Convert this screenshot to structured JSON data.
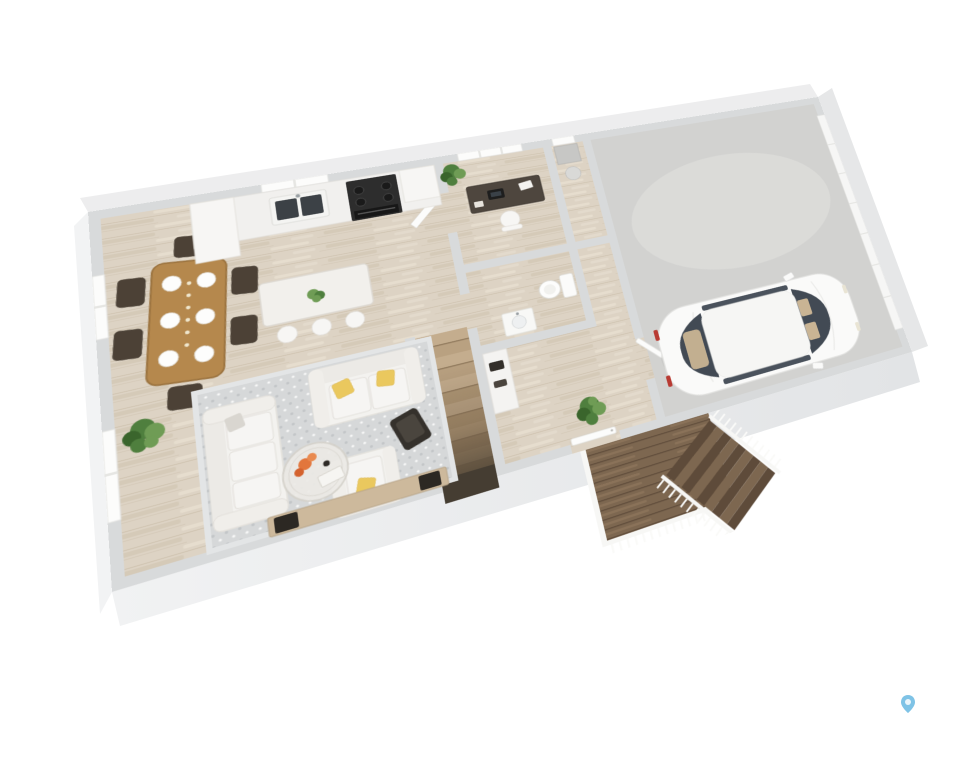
{
  "scene": {
    "type": "3d-floor-plan-render",
    "description": "Isometric 3D rendering of a home's main floor: open-concept dining area, kitchen with island, living room, rear office, powder room, central staircase, entry foyer, attached single-car garage with parked car, and an exterior deck with steps.",
    "background": "#ffffff"
  },
  "rooms": [
    "dining-area",
    "kitchen",
    "living-room",
    "office",
    "powder-room",
    "staircase",
    "entry-foyer",
    "utility-closet",
    "garage",
    "deck"
  ],
  "furniture": [
    "dining-table",
    "dining-chairs",
    "place-settings",
    "kitchen-counter",
    "sink",
    "gas-range",
    "refrigerator-cabinet",
    "kitchen-island",
    "bar-stools",
    "island-plant",
    "sofa",
    "loveseat",
    "armchair",
    "accent-chair",
    "coffee-table",
    "media-console",
    "area-rug",
    "floor-plant",
    "desk",
    "office-chair",
    "office-plant",
    "toilet",
    "vanity-sink",
    "hall-cabinet",
    "foyer-plant",
    "white-car",
    "garage-door",
    "front-door",
    "deck-steps",
    "deck-railing"
  ],
  "watermark": {
    "icon": "map-pin-icon",
    "color": "#7fc3e6",
    "inner": "#eaf5fb"
  },
  "colors": {
    "bg": "#ffffff",
    "wall": "#d8dadb",
    "wallFace": "#ededee",
    "wallBandL": "#f2f3f4",
    "wallBandB": "#e9ebec",
    "wallBandR": "#e6e7e8",
    "floorWood": "#ddd3c4",
    "plankStreak": "#cec2af",
    "plankLight": "#eae2d4",
    "garageFloor": "#d2d2d0",
    "garageFloorLight": "#dededc",
    "rug": "#d6d8d9",
    "rugDot": "#c3c6c8",
    "sofa": "#f3f2ef",
    "sofaShade": "#e3e1dc",
    "tableWood": "#b5884d",
    "tableWoodDark": "#9c7440",
    "chairDark": "#4c4136",
    "plantGreen": "#4f7f3e",
    "plantDark": "#3a652c",
    "plantLight": "#6f9c55",
    "pillowYellow": "#eac85e",
    "stairWood": "#c4ad8e",
    "deckWood": "#7d6750",
    "deckWoodDark": "#5e4b3a",
    "carBody": "#fafaf9",
    "carGlass": "#424a54",
    "carSeat": "#c9b494",
    "applianceBlack": "#2d2d2d",
    "consoleWood": "#cdb99c",
    "decorOrange": "#e2763c",
    "accentDark": "#35312c",
    "counter": "#f1f0ee",
    "sinkBasin": "#3c4146",
    "voidDark": "#453d32",
    "white": "#f7f6f4"
  }
}
